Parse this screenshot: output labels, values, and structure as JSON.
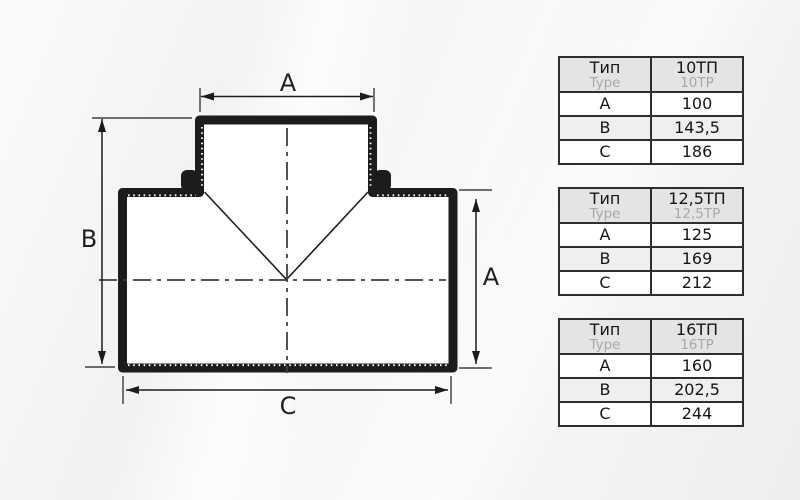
{
  "diagram": {
    "type": "tee-pipe-fitting-technical-drawing",
    "dim_labels": {
      "top": "A",
      "left": "B",
      "right": "A",
      "bottom": "C"
    }
  },
  "tables": [
    {
      "type_label_ru": "Тип",
      "type_label_en": "Type",
      "model_ru": "10ТП",
      "model_en": "10TP",
      "rows": [
        [
          "A",
          "100"
        ],
        [
          "B",
          "143,5"
        ],
        [
          "C",
          "186"
        ]
      ]
    },
    {
      "type_label_ru": "Тип",
      "type_label_en": "Type",
      "model_ru": "12,5ТП",
      "model_en": "12,5TP",
      "rows": [
        [
          "A",
          "125"
        ],
        [
          "B",
          "169"
        ],
        [
          "C",
          "212"
        ]
      ]
    },
    {
      "type_label_ru": "Тип",
      "type_label_en": "Type",
      "model_ru": "16ТП",
      "model_en": "16TP",
      "rows": [
        [
          "A",
          "160"
        ],
        [
          "B",
          "202,5"
        ],
        [
          "C",
          "244"
        ]
      ]
    }
  ],
  "colors": {
    "outline": "#1c1c1c",
    "centerline": "#3f3f3f",
    "table_border": "#2e2e2e",
    "header_bg": "#e4e4e4",
    "stripe_bg": "#efefef",
    "muted_text": "#a9a9a9"
  }
}
